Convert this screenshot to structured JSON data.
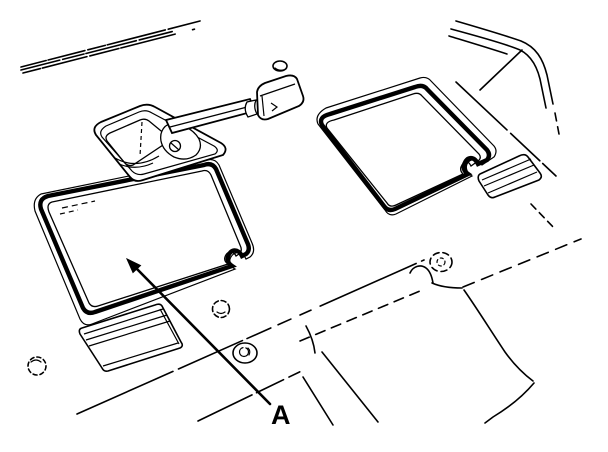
{
  "figure": {
    "callout": {
      "label": "A"
    },
    "colors": {
      "line": "#000000",
      "background": "#ffffff"
    },
    "parts": [
      "body-cowl-lines",
      "door-opening-lines",
      "gearshift-lever",
      "gearshift-knob",
      "shifter-base-plate",
      "floor-access-cover-left",
      "floor-access-cover-right",
      "carpet-flap-lower-left",
      "carpet-flap-right",
      "floor-grommets",
      "transmission-tunnel-lines",
      "callout-arrow"
    ]
  }
}
